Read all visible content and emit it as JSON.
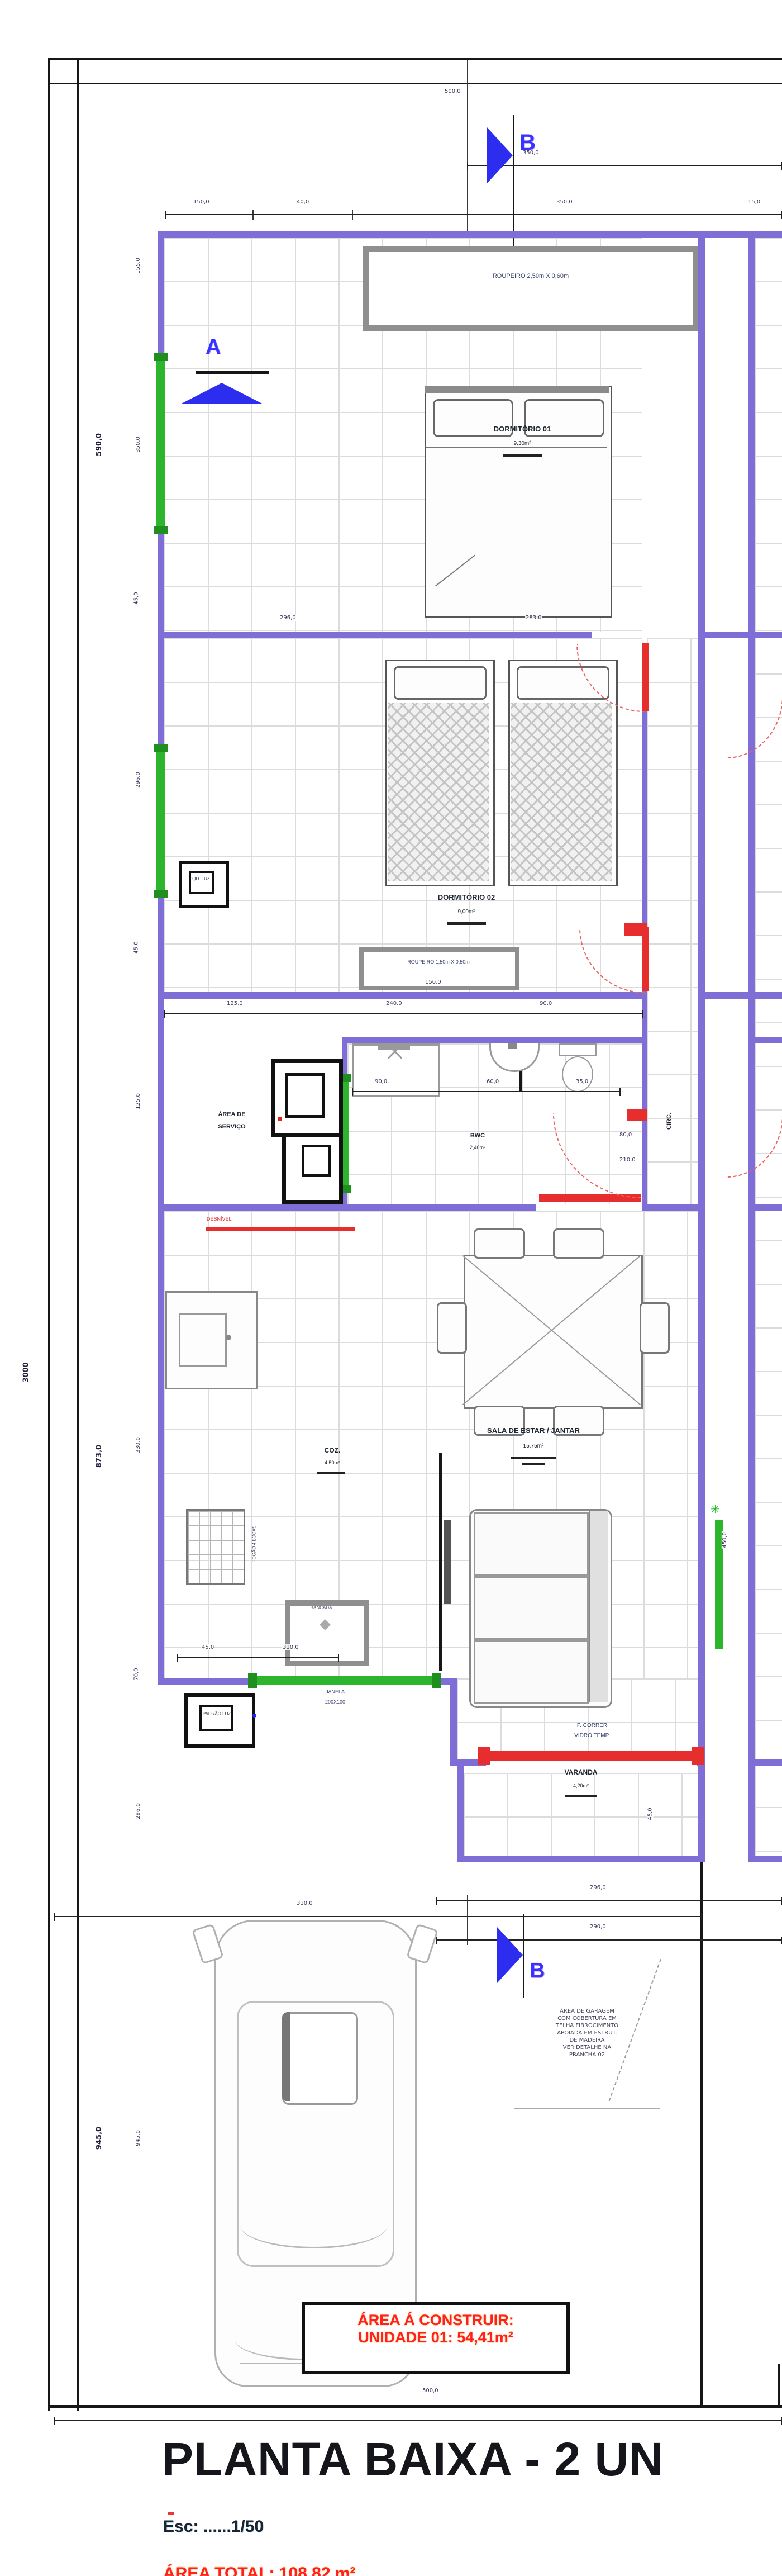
{
  "drawing": {
    "title": "PLANTA BAIXA - 2 UN",
    "scale": "Esc: ......1/50",
    "total_area_note": "ÁREA TOTAL: 108,82 m²",
    "area_box": {
      "line1": "ÁREA Á CONSTRUIR:",
      "line2": "UNIDADE 01: 54,41m²"
    },
    "sections": {
      "a": "A",
      "b": "B"
    }
  },
  "rooms": {
    "roupeiro1": "ROUPEIRO 2,50m X 0,60m",
    "dorm1": {
      "name": "DORMITÓRIO 01",
      "area": "9,30m²"
    },
    "dorm2": {
      "name": "DORMITÓRIO 02",
      "area": "9,00m²"
    },
    "roupeiro2": {
      "name": "ROUPEIRO 1,50m X 0,50m",
      "dim": "150,0"
    },
    "servico": {
      "line1": "ÁREA DE",
      "line2": "SERVIÇO"
    },
    "bwc": {
      "name": "BWC",
      "area": "2,40m²"
    },
    "circ": {
      "name": "CIRC."
    },
    "sala": {
      "name": "SALA DE ESTAR / JANTAR",
      "area": "15,75m²"
    },
    "cozinha": {
      "name": "COZ.",
      "area": "4,50m²"
    },
    "varanda": {
      "name": "VARANDA",
      "area": "4,20m²"
    }
  },
  "labels": {
    "porta_varanda1": "P. CORRER",
    "porta_varanda2": "VIDRO TEMP.",
    "janela_coz1": "JANELA",
    "janela_coz2": "200X100",
    "desnivel": "DESNÍVEL",
    "fogao": "FOGÃO 4 BOCAS",
    "bancada": "BANCADA",
    "padrao_luz": "PADRÃO LUZ",
    "quadro": "QD. LUZ"
  },
  "icons": {
    "green_star": "✳"
  },
  "notes": [
    "ÁREA DE GARAGEM",
    "COM COBERTURA EM",
    "TELHA FIBROCIMENTO",
    "APOIADA EM ESTRUT.",
    "DE MADEIRA",
    "VER DETALHE NA",
    "PRANCHA 02"
  ],
  "dims": {
    "top1": "500,0",
    "top2": "350,0",
    "top3a": "150,0",
    "top3b": "40,0",
    "top3c": "350,0",
    "top3d": "15,0",
    "left": [
      "155,0",
      "350,0",
      "45,0",
      "296,0",
      "45,0",
      "125,0",
      "330,0",
      "70,0",
      "296,0",
      "945,0"
    ],
    "left_bold1": "590,0",
    "left_bold2": "873,0",
    "left_bold3": "945,0",
    "lot_depth": "3000",
    "mid1": "296,0",
    "mid2": "283,0",
    "row_mid_a": "125,0",
    "row_mid_b": "240,0",
    "row_mid_c": "90,0",
    "bwc_a": "90,0",
    "bwc_b": "60,0",
    "bwc_c": "35,0",
    "door_a": "80,0",
    "door_b": "210,0",
    "kit_a": "45,0",
    "kit_b": "310,0",
    "sala_rot": "450,0",
    "var_rot": "45,0",
    "var_a": "296,0",
    "var_b": "290,0",
    "car": "310,0",
    "bottom": "500,0"
  }
}
